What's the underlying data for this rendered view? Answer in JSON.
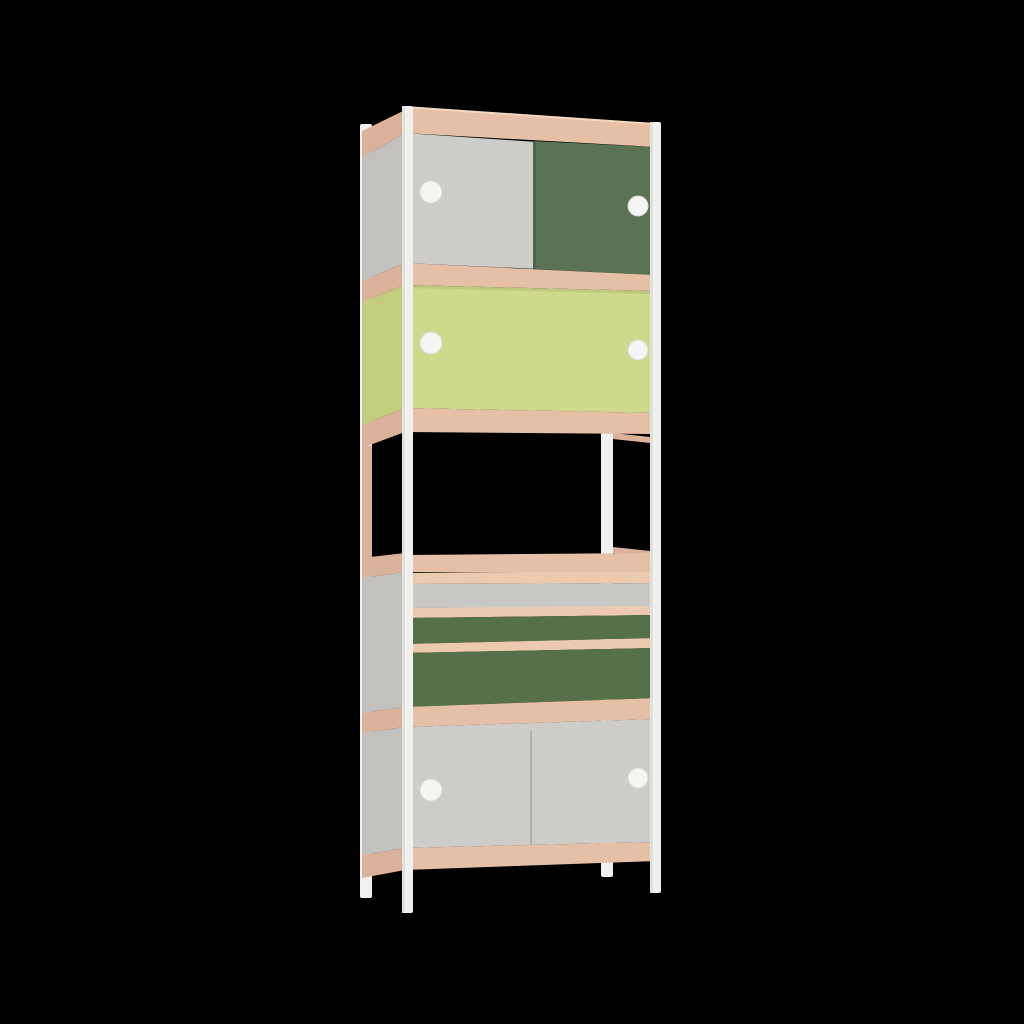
{
  "image": {
    "kind": "3d-product-render",
    "subject": "tall narrow modular shelving cabinet with white steel frame, plywood shelf edges, sliding doors and drawers",
    "background_color": "#000000"
  },
  "scene": {
    "width": 1024,
    "height": 1024,
    "palette": {
      "woodFront": "#e6c0a6",
      "woodLight": "#f3d8bf",
      "woodSide": "#d9b299",
      "woodStrip": "#eccab0",
      "grayFront": "#cdccc8",
      "grayDrawer": "#c9c8c4",
      "graySide": "#c2c1bd",
      "greenDoor": "#5b7354",
      "greenDrawer": "#567049",
      "lime": "#cfd98b",
      "limeSide": "#c2ce7d",
      "white": "#f0f1ee",
      "whiteShade": "#dfe1dd",
      "knob": "#f5f6f3",
      "knobRim": "#d8dad6",
      "seam": "#00000022",
      "shadow": "#00000014"
    },
    "parts": [
      {
        "name": "back-left-frame-post",
        "shape": "rect",
        "x": 360,
        "y": 124,
        "w": 12,
        "h": 774,
        "rx": 2,
        "fill": "white"
      },
      {
        "name": "back-right-frame-post",
        "shape": "rect",
        "x": 601,
        "y": 430,
        "w": 12,
        "h": 447,
        "rx": 2,
        "fill": "white"
      },
      {
        "name": "side-top-wood-band",
        "shape": "polygon",
        "points": [
          [
            362,
            131
          ],
          [
            405,
            110
          ],
          [
            405,
            133
          ],
          [
            362,
            158
          ]
        ],
        "fill": "woodSide"
      },
      {
        "name": "side-panel-top-cabinet",
        "shape": "polygon",
        "points": [
          [
            362,
            158
          ],
          [
            405,
            133
          ],
          [
            405,
            263
          ],
          [
            362,
            281
          ]
        ],
        "fill": "graySide"
      },
      {
        "name": "side-wood-band-2",
        "shape": "polygon",
        "points": [
          [
            362,
            281
          ],
          [
            405,
            263
          ],
          [
            405,
            285
          ],
          [
            362,
            302
          ]
        ],
        "fill": "woodSide"
      },
      {
        "name": "side-panel-lime-cabinet",
        "shape": "polygon",
        "points": [
          [
            362,
            302
          ],
          [
            405,
            285
          ],
          [
            405,
            408
          ],
          [
            362,
            425
          ]
        ],
        "fill": "limeSide"
      },
      {
        "name": "side-wood-band-3",
        "shape": "polygon",
        "points": [
          [
            362,
            425
          ],
          [
            405,
            408
          ],
          [
            405,
            432
          ],
          [
            362,
            448
          ]
        ],
        "fill": "woodSide"
      },
      {
        "name": "open-shelf-back-left-wood-strip",
        "shape": "rect",
        "x": 362,
        "y": 446,
        "w": 10,
        "h": 116,
        "fill": "woodSide"
      },
      {
        "name": "side-wood-band-4",
        "shape": "polygon",
        "points": [
          [
            362,
            558
          ],
          [
            405,
            553
          ],
          [
            405,
            572
          ],
          [
            362,
            578
          ]
        ],
        "fill": "woodSide"
      },
      {
        "name": "side-panel-drawer-cabinet",
        "shape": "polygon",
        "points": [
          [
            362,
            578
          ],
          [
            405,
            572
          ],
          [
            405,
            707
          ],
          [
            362,
            713
          ]
        ],
        "fill": "graySide"
      },
      {
        "name": "side-wood-band-5",
        "shape": "polygon",
        "points": [
          [
            362,
            713
          ],
          [
            405,
            707
          ],
          [
            405,
            727
          ],
          [
            362,
            733
          ]
        ],
        "fill": "woodSide"
      },
      {
        "name": "side-panel-bottom-cabinet",
        "shape": "polygon",
        "points": [
          [
            362,
            733
          ],
          [
            405,
            727
          ],
          [
            405,
            848
          ],
          [
            362,
            855
          ]
        ],
        "fill": "graySide"
      },
      {
        "name": "side-wood-band-6",
        "shape": "polygon",
        "points": [
          [
            362,
            855
          ],
          [
            405,
            848
          ],
          [
            405,
            870
          ],
          [
            362,
            878
          ]
        ],
        "fill": "woodSide"
      },
      {
        "name": "open-shelf-right-top-edge",
        "shape": "polygon",
        "points": [
          [
            613,
            433
          ],
          [
            650,
            437
          ],
          [
            650,
            443
          ],
          [
            613,
            439
          ]
        ],
        "fill": "woodSide"
      },
      {
        "name": "open-shelf-right-bottom-edge",
        "shape": "polygon",
        "points": [
          [
            613,
            547
          ],
          [
            650,
            551
          ],
          [
            650,
            557
          ],
          [
            613,
            553
          ]
        ],
        "fill": "woodSide"
      },
      {
        "name": "top-edge-highlight",
        "shape": "polygon",
        "points": [
          [
            405,
            106
          ],
          [
            655,
            123
          ],
          [
            655,
            127
          ],
          [
            405,
            110
          ]
        ],
        "fill": "woodLight"
      },
      {
        "name": "top-wood-band",
        "shape": "polygon",
        "points": [
          [
            405,
            108
          ],
          [
            655,
            125
          ],
          [
            655,
            147
          ],
          [
            405,
            133
          ]
        ],
        "fill": "woodFront"
      },
      {
        "name": "top-sliding-door-gray",
        "shape": "polygon",
        "points": [
          [
            405,
            133
          ],
          [
            537,
            142
          ],
          [
            537,
            269
          ],
          [
            405,
            263
          ]
        ],
        "fill": "grayFront"
      },
      {
        "name": "top-sliding-door-green",
        "shape": "polygon",
        "points": [
          [
            533,
            141
          ],
          [
            655,
            147
          ],
          [
            655,
            275
          ],
          [
            533,
            269
          ]
        ],
        "fill": "greenDoor"
      },
      {
        "name": "top-door-seam",
        "shape": "polygon",
        "points": [
          [
            533,
            141
          ],
          [
            536,
            141
          ],
          [
            536,
            269
          ],
          [
            533,
            269
          ]
        ],
        "fill": "seam"
      },
      {
        "name": "wood-band-2",
        "shape": "polygon",
        "points": [
          [
            405,
            263
          ],
          [
            655,
            275
          ],
          [
            655,
            291
          ],
          [
            405,
            285
          ]
        ],
        "fill": "woodFront"
      },
      {
        "name": "lime-sliding-doors",
        "shape": "polygon",
        "points": [
          [
            405,
            285
          ],
          [
            655,
            291
          ],
          [
            655,
            413
          ],
          [
            405,
            408
          ]
        ],
        "fill": "lime"
      },
      {
        "name": "lime-doors-top-shadow",
        "shape": "polygon",
        "points": [
          [
            405,
            285
          ],
          [
            655,
            291
          ],
          [
            655,
            294
          ],
          [
            405,
            288
          ]
        ],
        "fill": "shadow"
      },
      {
        "name": "wood-band-3",
        "shape": "polygon",
        "points": [
          [
            405,
            408
          ],
          [
            655,
            413
          ],
          [
            655,
            434
          ],
          [
            405,
            432
          ]
        ],
        "fill": "woodFront"
      },
      {
        "name": "wood-band-4",
        "shape": "polygon",
        "points": [
          [
            405,
            555
          ],
          [
            655,
            553
          ],
          [
            655,
            574
          ],
          [
            405,
            572
          ]
        ],
        "fill": "woodFront"
      },
      {
        "name": "drawer-rail-1",
        "shape": "polygon",
        "points": [
          [
            405,
            573
          ],
          [
            656,
            572
          ],
          [
            656,
            583
          ],
          [
            405,
            584
          ]
        ],
        "fill": "woodStrip"
      },
      {
        "name": "drawer-front-gray",
        "shape": "polygon",
        "points": [
          [
            405,
            584
          ],
          [
            656,
            583
          ],
          [
            656,
            607
          ],
          [
            405,
            608
          ]
        ],
        "fill": "grayDrawer"
      },
      {
        "name": "drawer-rail-2",
        "shape": "polygon",
        "points": [
          [
            405,
            608
          ],
          [
            656,
            606
          ],
          [
            656,
            615
          ],
          [
            405,
            618
          ]
        ],
        "fill": "woodStrip"
      },
      {
        "name": "drawer-front-green-small",
        "shape": "polygon",
        "points": [
          [
            405,
            618
          ],
          [
            656,
            615
          ],
          [
            656,
            638
          ],
          [
            405,
            644
          ]
        ],
        "fill": "greenDrawer"
      },
      {
        "name": "drawer-rail-3",
        "shape": "polygon",
        "points": [
          [
            405,
            644
          ],
          [
            656,
            638
          ],
          [
            656,
            648
          ],
          [
            405,
            653
          ]
        ],
        "fill": "woodStrip"
      },
      {
        "name": "drawer-front-green-large",
        "shape": "polygon",
        "points": [
          [
            405,
            653
          ],
          [
            656,
            648
          ],
          [
            656,
            698
          ],
          [
            405,
            707
          ]
        ],
        "fill": "greenDrawer"
      },
      {
        "name": "wood-band-5",
        "shape": "polygon",
        "points": [
          [
            405,
            707
          ],
          [
            656,
            698
          ],
          [
            656,
            719
          ],
          [
            405,
            727
          ]
        ],
        "fill": "woodFront"
      },
      {
        "name": "bottom-sliding-doors-gray",
        "shape": "polygon",
        "points": [
          [
            405,
            727
          ],
          [
            656,
            719
          ],
          [
            656,
            842
          ],
          [
            405,
            848
          ]
        ],
        "fill": "grayFront"
      },
      {
        "name": "bottom-door-seam",
        "shape": "polygon",
        "points": [
          [
            530,
            731
          ],
          [
            532,
            731
          ],
          [
            532,
            845
          ],
          [
            530,
            845
          ]
        ],
        "fill": "seam"
      },
      {
        "name": "bottom-wood-band",
        "shape": "polygon",
        "points": [
          [
            405,
            848
          ],
          [
            656,
            842
          ],
          [
            656,
            861
          ],
          [
            405,
            870
          ]
        ],
        "fill": "woodFront"
      },
      {
        "name": "front-left-frame-post",
        "shape": "rect",
        "x": 402,
        "y": 106,
        "w": 11,
        "h": 807,
        "rx": 2,
        "fill": "white"
      },
      {
        "name": "front-left-frame-post-shade",
        "shape": "rect",
        "x": 402,
        "y": 106,
        "w": 3,
        "h": 807,
        "fill": "whiteShade"
      },
      {
        "name": "front-right-frame-post",
        "shape": "rect",
        "x": 650,
        "y": 122,
        "w": 11,
        "h": 771,
        "rx": 2,
        "fill": "white"
      },
      {
        "name": "front-right-frame-post-shade",
        "shape": "rect",
        "x": 650,
        "y": 122,
        "w": 3,
        "h": 771,
        "fill": "whiteShade"
      },
      {
        "name": "knob-top-door-left",
        "shape": "circle",
        "cx": 431,
        "cy": 192,
        "r": 11,
        "fill": "knob",
        "stroke": "knobRim"
      },
      {
        "name": "knob-top-door-right",
        "shape": "circle",
        "cx": 638,
        "cy": 206,
        "r": 10,
        "fill": "knob",
        "stroke": "knobRim"
      },
      {
        "name": "knob-lime-door-left",
        "shape": "circle",
        "cx": 431,
        "cy": 343,
        "r": 11,
        "fill": "knob",
        "stroke": "knobRim"
      },
      {
        "name": "knob-lime-door-right",
        "shape": "circle",
        "cx": 638,
        "cy": 350,
        "r": 10,
        "fill": "knob",
        "stroke": "knobRim"
      },
      {
        "name": "knob-bottom-door-left",
        "shape": "circle",
        "cx": 431,
        "cy": 790,
        "r": 11,
        "fill": "knob",
        "stroke": "knobRim"
      },
      {
        "name": "knob-bottom-door-right",
        "shape": "circle",
        "cx": 638,
        "cy": 778,
        "r": 10,
        "fill": "knob",
        "stroke": "knobRim"
      }
    ]
  }
}
